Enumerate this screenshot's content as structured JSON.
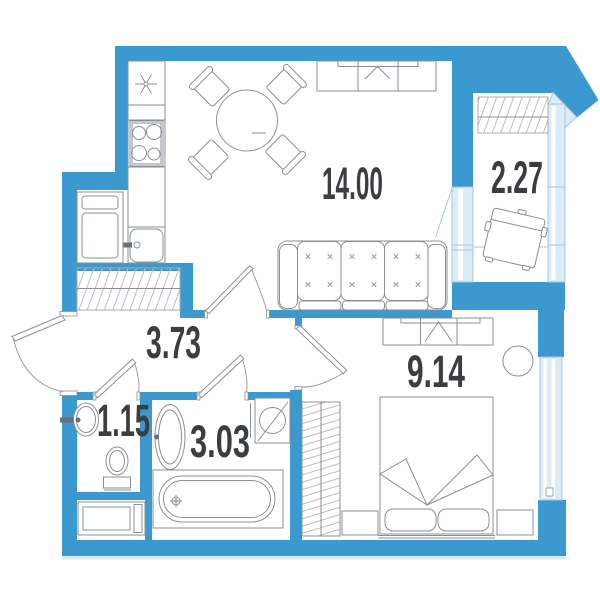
{
  "plan": {
    "type": "apartment-floor-plan",
    "rooms": [
      {
        "name": "living-room-kitchen",
        "area": "14.00"
      },
      {
        "name": "balcony",
        "area": "2.27"
      },
      {
        "name": "hallway",
        "area": "3.73"
      },
      {
        "name": "toilet",
        "area": "1.15"
      },
      {
        "name": "bathroom",
        "area": "3.03"
      },
      {
        "name": "bedroom",
        "area": "9.14"
      }
    ],
    "colors": {
      "wall": "#3B99CF",
      "window_fill": "#DCEBF6",
      "window_stroke": "#A5C8DE",
      "furniture_line": "#8A9095",
      "hatch_line": "#B9BFC4",
      "label": "#3B3E41",
      "background": "#FFFFFF"
    },
    "icons": [
      "cooktop-icon",
      "kitchen-sink-icon",
      "fridge-icon",
      "light-star-icon",
      "dining-table-icon",
      "chair-icon",
      "sofa-icon",
      "wardrobe-icon",
      "closet-hatch-icon",
      "armchair-icon",
      "bed-icon",
      "nightstand-icon",
      "pouf-icon",
      "bathtub-icon",
      "washing-machine-icon",
      "toilet-icon",
      "sink-icon",
      "cabinet-icon",
      "door-swing-icon",
      "window-icon"
    ]
  }
}
